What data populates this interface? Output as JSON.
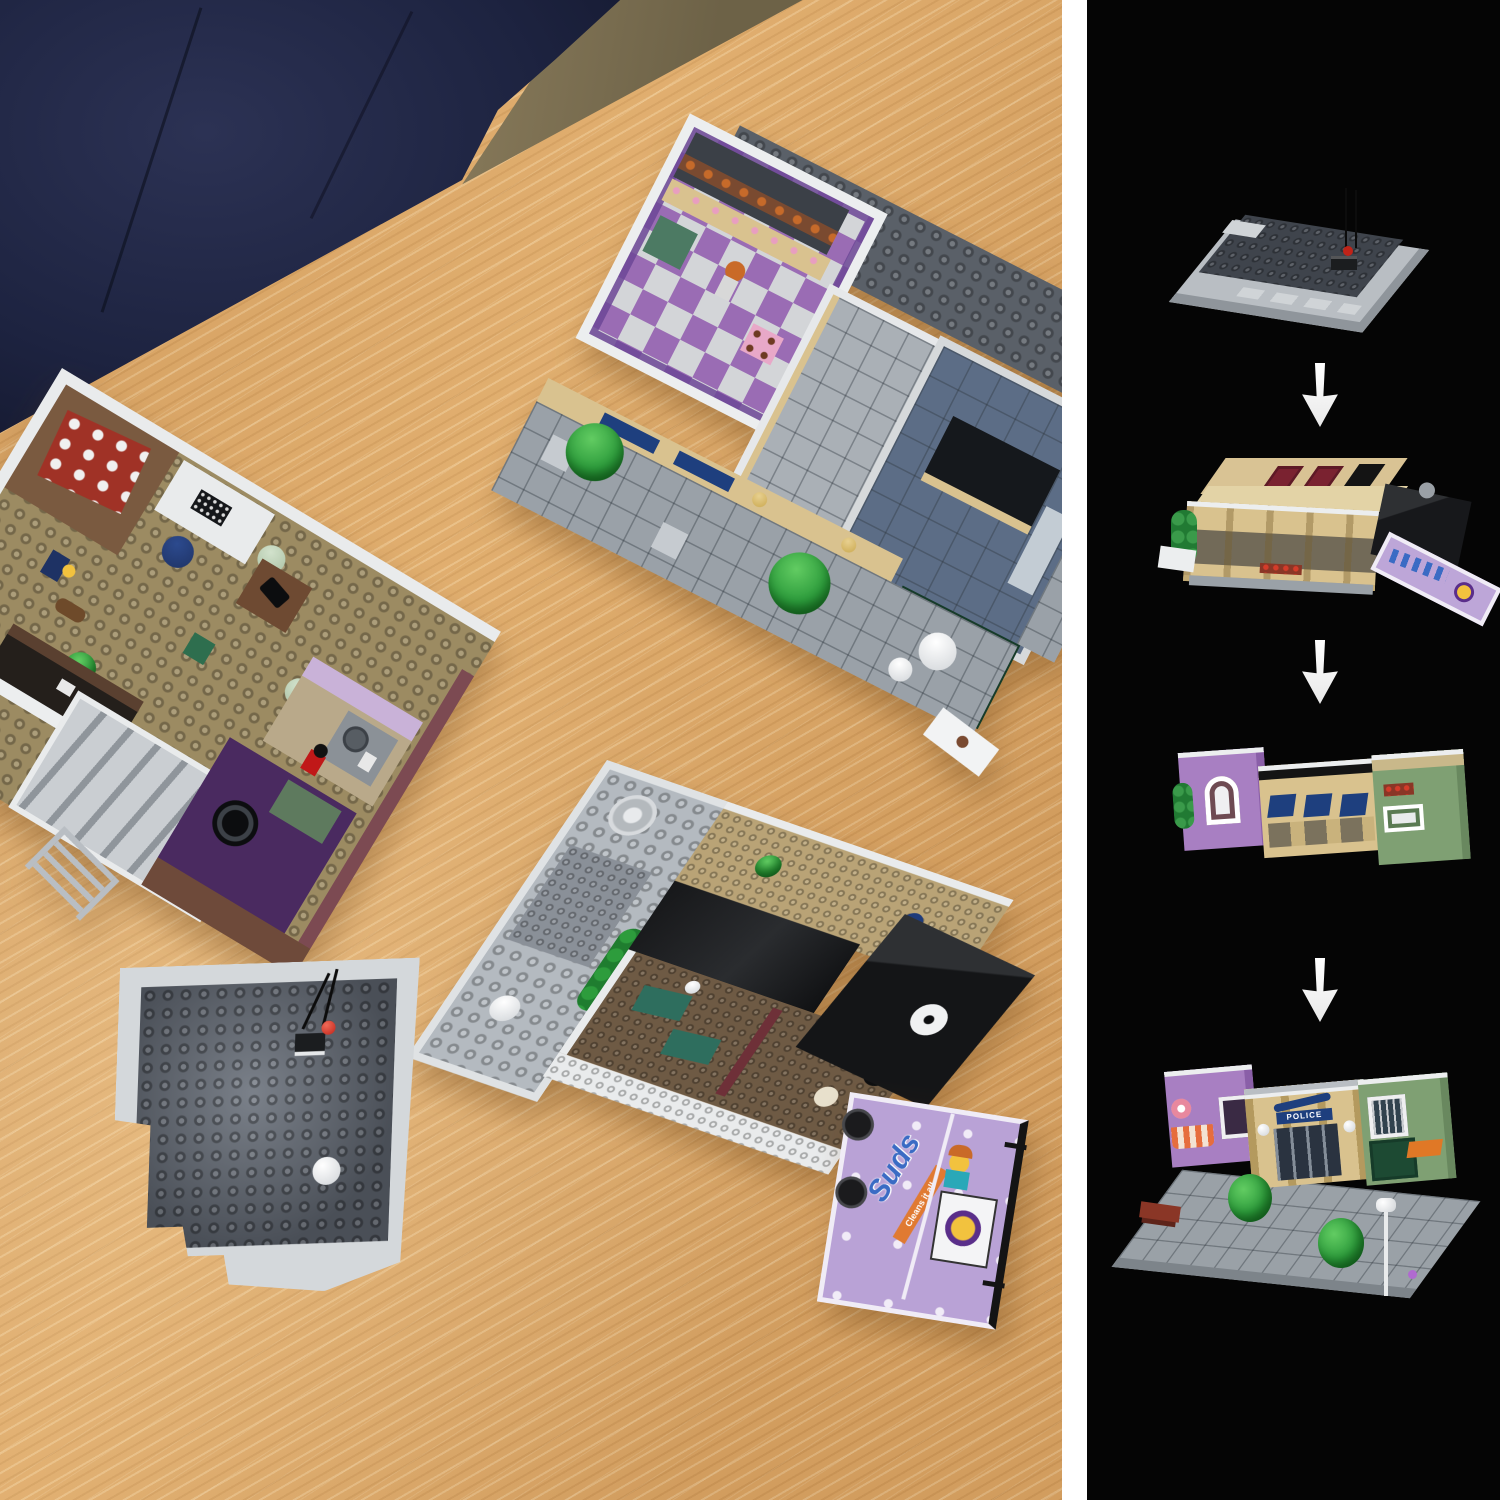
{
  "scene": {
    "type": "product-photo",
    "subject": "LEGO modular police-station building separated into its floor sections on a light oak table, with a 4-step stacking sequence shown on a black side panel",
    "photo": {
      "table": {
        "material": "light oak wood",
        "color": "#dca767"
      },
      "armchair": {
        "color": "#222842",
        "position": "top-left"
      },
      "floor_beyond_table": {
        "color": "#7d6f52"
      },
      "modules": [
        {
          "id": "ground-floor-section",
          "position": "top-right",
          "description": "ground floor: purple-and-white checkered donut-shop floor, grey lobby tiles, blue-grey office room with black desks and telephone, dark-grey jail baseplate, sidewalk with trees, dark-green dumpster and orange piece"
        },
        {
          "id": "first-floor-section",
          "position": "left",
          "description": "first floor: dark tan studded floor, archive room with red ladder shelf, white desk with typewriter, navy chair, lamps, officer and dog minifigures, light-grey staircase, lavender kitchen, dark purple music room with turntable, grey ladder"
        },
        {
          "id": "second-floor-section",
          "position": "bottom-center",
          "description": "apartment floor: light-grey plate with silver dome, dark-brown bedroom floor with teal furniture, black roof section with white dish, laundromat billboard"
        },
        {
          "id": "roof-section",
          "position": "bottom-left",
          "description": "roof: dark-grey studded plate with light-grey parapet, black antenna with red light, white chimney cylinder"
        }
      ]
    },
    "signs": {
      "police": "POLICE",
      "laundry_word": "Suds",
      "laundry_tagline": "Cleans it all"
    },
    "sidebar": {
      "background": "#050505",
      "divider_color": "#ffffff",
      "arrow_icon": "down-arrow",
      "arrow_color": "#ffffff",
      "steps": [
        {
          "id": "step-1",
          "name": "foundation-base"
        },
        {
          "id": "step-2",
          "name": "ground-floor"
        },
        {
          "id": "step-3",
          "name": "upper-floor"
        },
        {
          "id": "step-4",
          "name": "finished-building"
        }
      ]
    },
    "palette": {
      "lego_tan": "#d9c28e",
      "lego_light_grey": "#c6cacd",
      "lego_dark_grey": "#4d535b",
      "lego_purple": "#9d6cb8",
      "lego_lavender": "#c9b2d8",
      "lego_sand_green": "#7fa073",
      "lego_dark_green": "#1d4a33",
      "lego_navy": "#1e3f7e",
      "lego_brown": "#6e5a44",
      "lego_red": "#c0392b",
      "foliage_green": "#2d9c3c"
    }
  }
}
